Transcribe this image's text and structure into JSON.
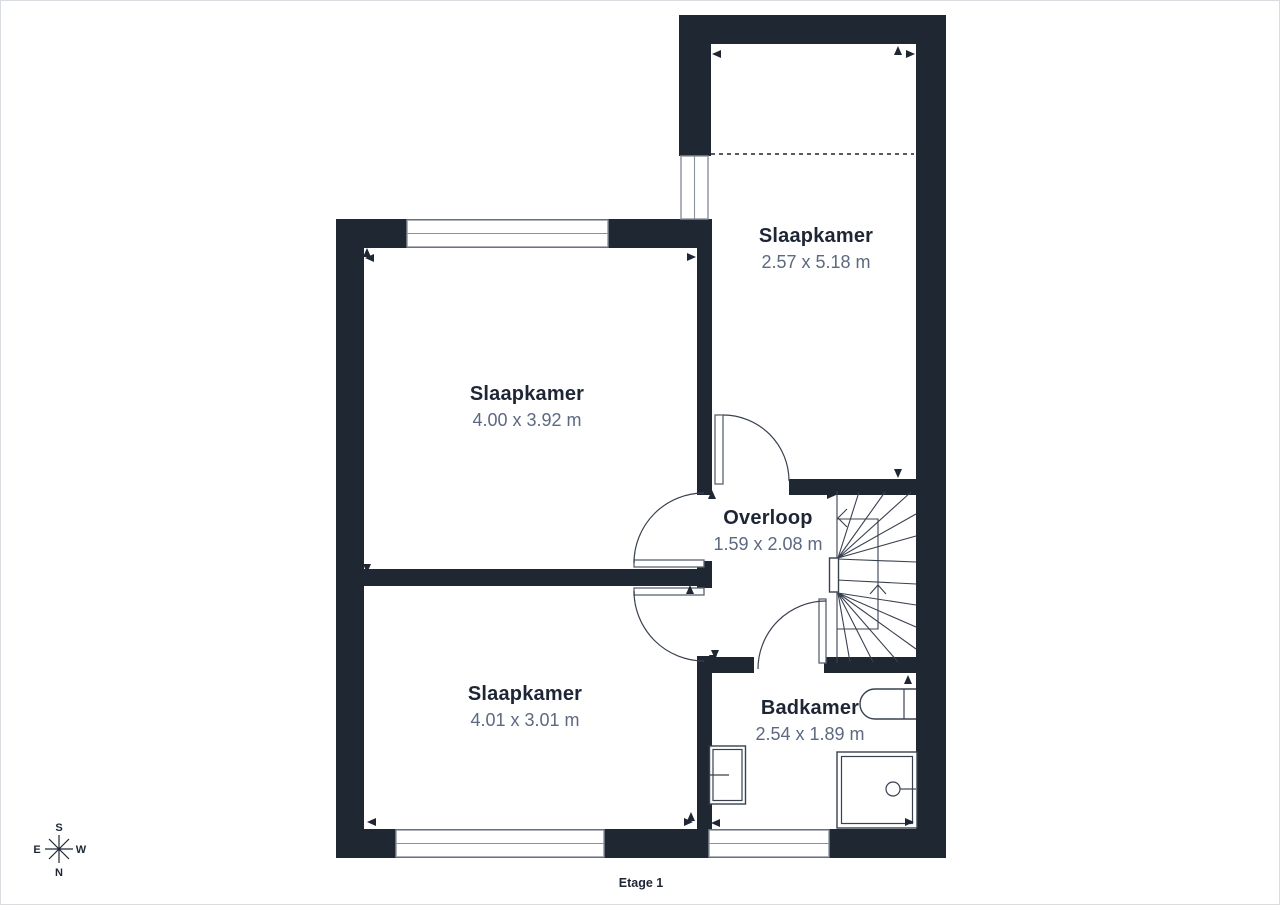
{
  "floor": {
    "label": "Etage 1"
  },
  "rooms": [
    {
      "id": "slaapkamer-noordoost",
      "name": "Slaapkamer",
      "dimensions": "2.57 x 5.18 m"
    },
    {
      "id": "slaapkamer-noordwest",
      "name": "Slaapkamer",
      "dimensions": "4.00 x 3.92 m"
    },
    {
      "id": "overloop",
      "name": "Overloop",
      "dimensions": "1.59 x 2.08 m"
    },
    {
      "id": "slaapkamer-zuidwest",
      "name": "Slaapkamer",
      "dimensions": "4.01 x 3.01 m"
    },
    {
      "id": "badkamer",
      "name": "Badkamer",
      "dimensions": "2.54 x 1.89 m"
    }
  ],
  "compass": {
    "north": "N",
    "south": "S",
    "east": "E",
    "west": "W"
  },
  "colors": {
    "wall": "#1f2733",
    "title_text": "#1e2636",
    "dimension_text": "#5d6980",
    "line": "#39414f",
    "window_border": "#8a919c"
  }
}
